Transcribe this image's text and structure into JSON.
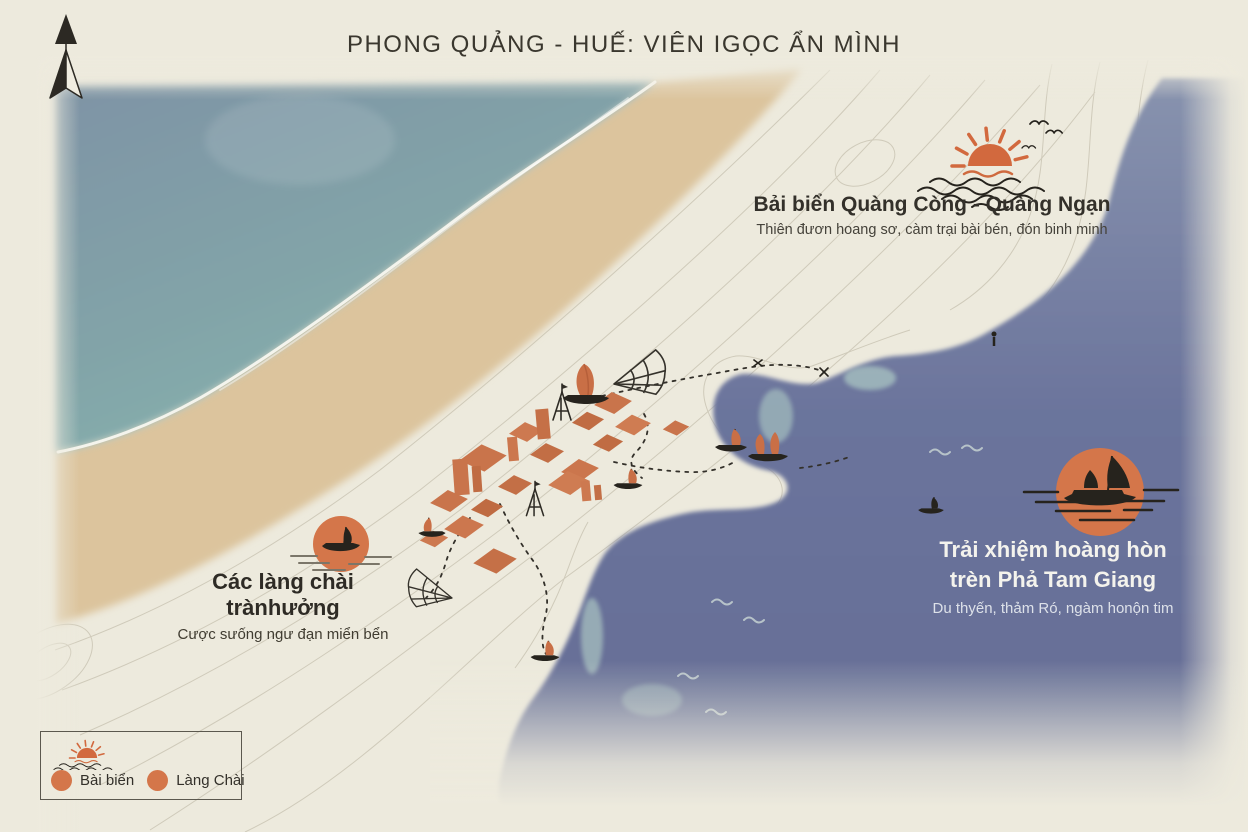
{
  "title": "PHONG QUẢNG - HUẾ: VIÊN IGỌC ẨN MÌNH",
  "pois": {
    "beach": {
      "name": "Bải biển Quàng Còng - Quàng Ngạn",
      "description": "Thiên đươn hoang sơ, càm trại bài bén, đón binh minh",
      "icon": "sunrise-icon"
    },
    "lagoon": {
      "name_line1": "Trải xhiệm hoàng hòn",
      "name_line2": "trèn Phả Tam Giang",
      "description": "Du thyến, thảm Ró, ngàm honộn tim",
      "icon": "boat-in-sun-icon"
    },
    "village": {
      "name": "Các làng chài trànhưởng",
      "description": "Cược sưống ngư đạn miển bển",
      "icon": "boat-in-sun-icon"
    }
  },
  "legend": {
    "icon": "sunrise-icon",
    "items": [
      {
        "label": "Bài biển",
        "marker_color": "#d4764a"
      },
      {
        "label": "Làng Chài",
        "marker_color": "#d4764a"
      }
    ]
  },
  "compass": {
    "icon": "north-arrow-icon"
  },
  "map_icons": [
    "north-arrow-icon",
    "sunrise-icon",
    "boat-icon",
    "junk-boat-icon",
    "fishing-net-icon",
    "tripod-icon",
    "bird-icon",
    "wave-icon",
    "house-roof-icon",
    "dashed-trail"
  ],
  "colors": {
    "paper": "#edeadd",
    "sea_deep": "#7e93a5",
    "sea_shallow": "#85b2ad",
    "sand": "#dcc49d",
    "lagoon_top": "#8691ad",
    "lagoon": "#68719a",
    "accent": "#d4764a",
    "roof": "#c9744b",
    "ink": "#2e2b25",
    "contour": "#bcb6a3",
    "label_light": "#f4f3ed"
  }
}
